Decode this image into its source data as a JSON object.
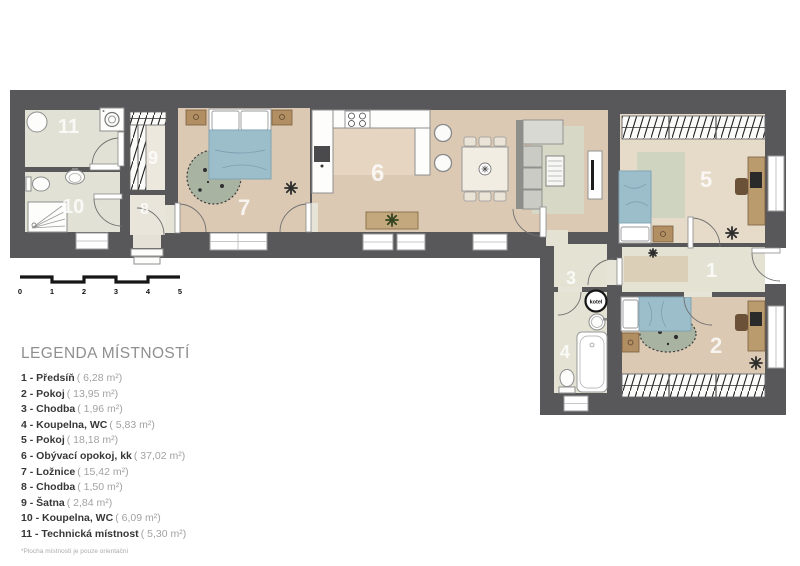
{
  "plan": {
    "rooms": [
      {
        "number": "1"
      },
      {
        "number": "2"
      },
      {
        "number": "3"
      },
      {
        "number": "4"
      },
      {
        "number": "5"
      },
      {
        "number": "6"
      },
      {
        "number": "7"
      },
      {
        "number": "8"
      },
      {
        "number": "9"
      },
      {
        "number": "10"
      },
      {
        "number": "11"
      }
    ],
    "boiler_label": "kotel"
  },
  "scale_bar": {
    "ticks": [
      "0",
      "1",
      "2",
      "3",
      "4",
      "5"
    ]
  },
  "legend": {
    "title": "LEGENDA MÍSTNOSTÍ",
    "items": [
      {
        "label": "1 - Předsíň",
        "area": "( 6,28 m²)"
      },
      {
        "label": "2 - Pokoj",
        "area": "( 13,95 m²)"
      },
      {
        "label": "3 - Chodba",
        "area": "( 1,96 m²)"
      },
      {
        "label": "4 - Koupelna, WC",
        "area": "( 5,83 m²)"
      },
      {
        "label": "5 - Pokoj",
        "area": "( 18,18 m²)"
      },
      {
        "label": "6 - Obývací opokoj, kk",
        "area": "( 37,02 m²)"
      },
      {
        "label": "7 - Ložnice",
        "area": "( 15,42 m²)"
      },
      {
        "label": "8 - Chodba",
        "area": "( 1,50 m²)"
      },
      {
        "label": "9 - Šatna",
        "area": "( 2,84 m²)"
      },
      {
        "label": "10 - Koupelna, WC",
        "area": "( 6,09 m²)"
      },
      {
        "label": "11 - Technická místnost",
        "area": "( 5,30 m²)"
      }
    ],
    "footnote": "*Plocha místností je pouze orientační"
  },
  "colors": {
    "wall": "#58585a",
    "wood_floor": "#dbc9b3",
    "tile_floor": "#e2e2d5",
    "bed_blue": "#9cbecb",
    "rug_green": "#a9b3a1"
  }
}
